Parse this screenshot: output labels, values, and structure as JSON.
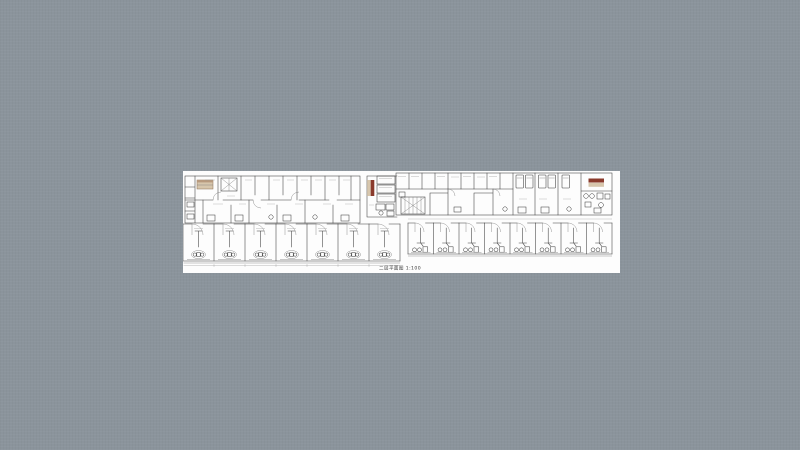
{
  "page": {
    "background_color": "#8b949c"
  },
  "canvas": {
    "background_color": "#fdfdfd"
  },
  "drawing": {
    "caption": "二层平面图 1:100",
    "colors": {
      "line": "#3d3d3d",
      "line_light": "#8a8a8a",
      "highlight_red": "#8a3a2c",
      "fill_tan": "#d7c6ac",
      "fill_tan_dark": "#b89a7e"
    }
  }
}
